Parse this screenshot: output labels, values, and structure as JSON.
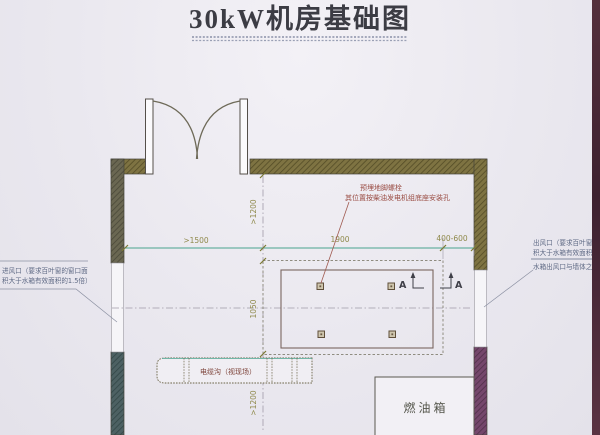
{
  "title": "30kW机房基础图",
  "dims": {
    "h": [
      ">1500",
      "1900",
      "400-600"
    ],
    "v": [
      ">1200",
      "1050",
      ">1200"
    ]
  },
  "notes": {
    "anchor_bolt": {
      "line1": "预埋地脚螺栓",
      "line2": "其位置按柴油发电机组底座安装孔"
    },
    "air_inlet": {
      "line1": "进风口（要求百叶窗的窗口面",
      "line2": "积大于水箱有效面积的1.5倍）"
    },
    "air_outlet": {
      "line1": "出风口（要求百叶窗的窗口面",
      "line2": "积大于水箱有效面积的1.5倍）",
      "line3": "水箱出风口与墙体之间装软连接"
    },
    "cable_trench": "电缆沟（视现场）",
    "fuel_tank": "燃油箱",
    "section_marker": "A"
  },
  "colors": {
    "paper": "#eae8ef",
    "wall_olive": "#7e7342",
    "wall_gray_olive": "#6a6752",
    "wall_teal": "#4d6163",
    "wall_purple": "#75476c",
    "dim_line_teal": "#49a38e",
    "dim_text_olive": "#8f894b",
    "note_red": "#9a4d44",
    "note_blue": "#5f6a85",
    "scan_edge_maroon": "#4c2733"
  }
}
